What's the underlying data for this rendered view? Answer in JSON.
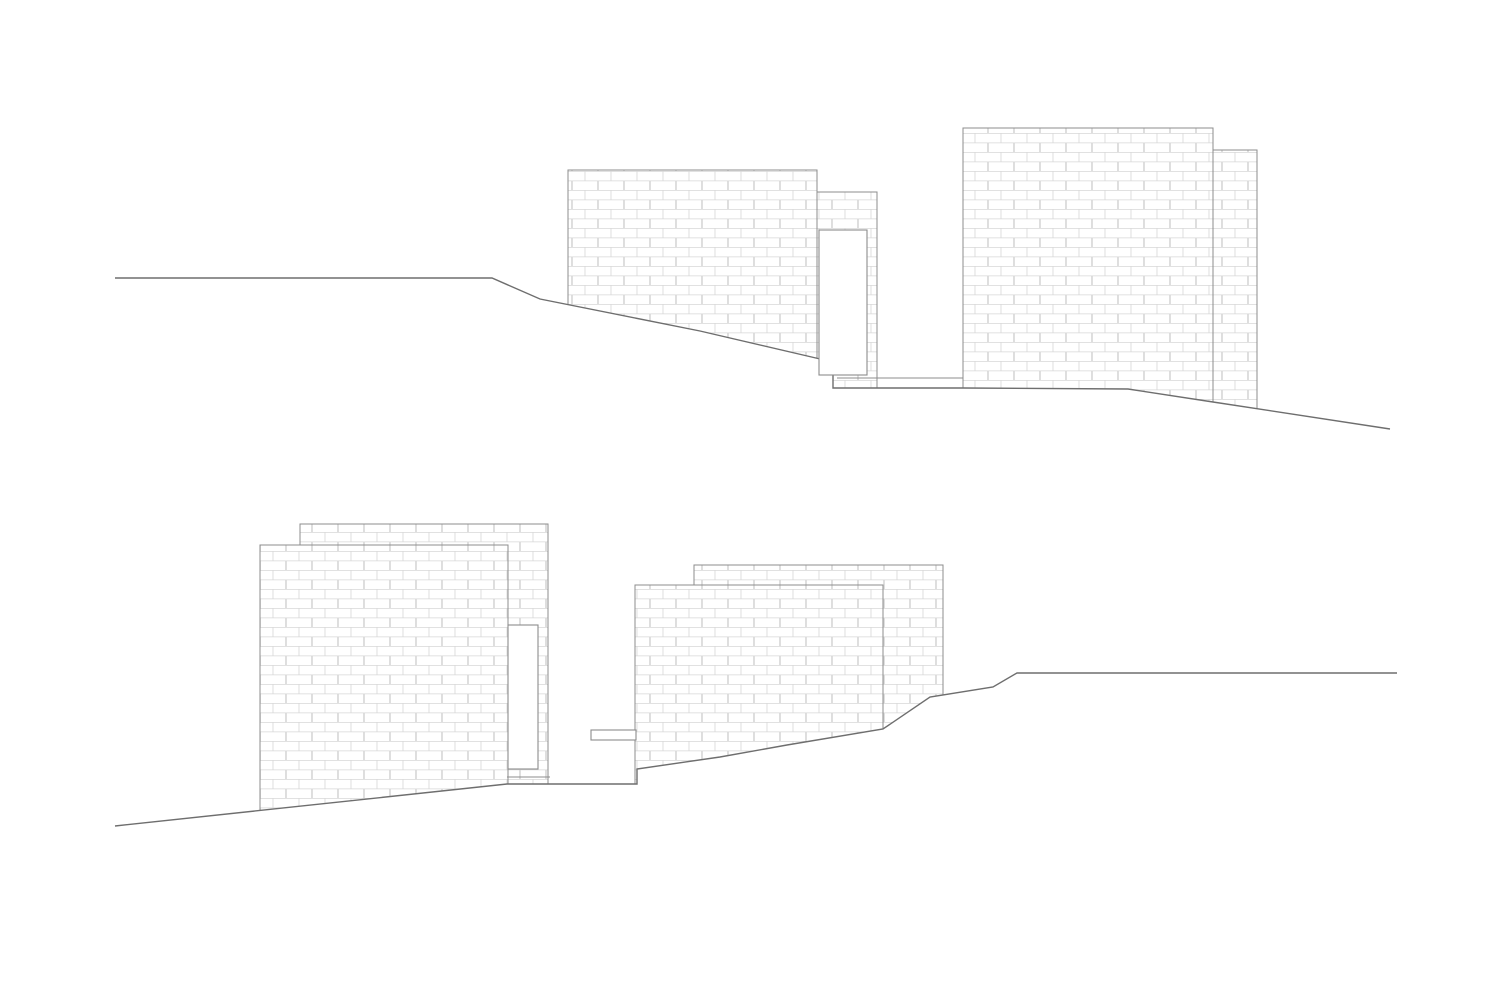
{
  "page": {
    "background": "#ffffff"
  },
  "drawing": {
    "canvas": {
      "width": 1512,
      "height": 981
    },
    "colors": {
      "background": "#ffffff",
      "wall_outline": "#8c8c8c",
      "terrain_line": "#6e6e6e",
      "brick_joint": "#d7d7d7"
    },
    "brick": {
      "length": 26,
      "course_height": 9.5,
      "joint_width": 0.8
    },
    "elevations": [
      {
        "name": "upper-elevation",
        "walls": [
          {
            "name": "upper-back-narrow-wall",
            "x": 817,
            "y": 192,
            "w": 60,
            "h": 196
          },
          {
            "name": "upper-left-large-wall",
            "x": 568,
            "y": 170,
            "w": 249,
            "h": 200
          },
          {
            "name": "upper-right-thin-wall",
            "x": 1213,
            "y": 150,
            "w": 44,
            "h": 270
          },
          {
            "name": "upper-right-large-wall",
            "x": 963,
            "y": 128,
            "w": 250,
            "h": 292
          }
        ],
        "terrain": [
          [
            115,
            278
          ],
          [
            492,
            278
          ],
          [
            540,
            299
          ],
          [
            700,
            331
          ],
          [
            833,
            362
          ],
          [
            833,
            388
          ],
          [
            963,
            388
          ],
          [
            1128,
            389
          ],
          [
            1213,
            402
          ],
          [
            1390,
            429
          ]
        ],
        "lines": [
          {
            "name": "upper-plinth-line",
            "points": [
              [
                837,
                378
              ],
              [
                963,
                378
              ]
            ]
          }
        ],
        "openings": [
          {
            "name": "upper-door-opening",
            "x": 819,
            "y": 230,
            "w": 48,
            "h": 145
          }
        ],
        "mask_left": 98,
        "mask_right": 1404,
        "mask_bottom": 478
      },
      {
        "name": "lower-elevation",
        "walls": [
          {
            "name": "lower-back-left-wall",
            "x": 300,
            "y": 524,
            "w": 248,
            "h": 260
          },
          {
            "name": "lower-front-left-wall",
            "x": 260,
            "y": 545,
            "w": 248,
            "h": 290
          },
          {
            "name": "lower-back-right-wall",
            "x": 694,
            "y": 565,
            "w": 249,
            "h": 225
          },
          {
            "name": "lower-front-right-wall",
            "x": 635,
            "y": 585,
            "w": 248,
            "h": 215
          }
        ],
        "terrain": [
          [
            115,
            826
          ],
          [
            507,
            784
          ],
          [
            637,
            784
          ],
          [
            637,
            769
          ],
          [
            720,
            757
          ],
          [
            787,
            745
          ],
          [
            883,
            729
          ],
          [
            930,
            697
          ],
          [
            993,
            687
          ],
          [
            1017,
            673
          ],
          [
            1397,
            673
          ]
        ],
        "lines": [
          {
            "name": "lower-plinth-line",
            "points": [
              [
                507,
                777
              ],
              [
                550,
                777
              ]
            ]
          }
        ],
        "openings": [
          {
            "name": "lower-door-opening",
            "x": 508,
            "y": 625,
            "w": 30,
            "h": 144
          },
          {
            "name": "lower-bench-step",
            "x": 591,
            "y": 730,
            "w": 45,
            "h": 10
          }
        ],
        "mask_left": 98,
        "mask_right": 1404,
        "mask_bottom": 940
      }
    ]
  }
}
